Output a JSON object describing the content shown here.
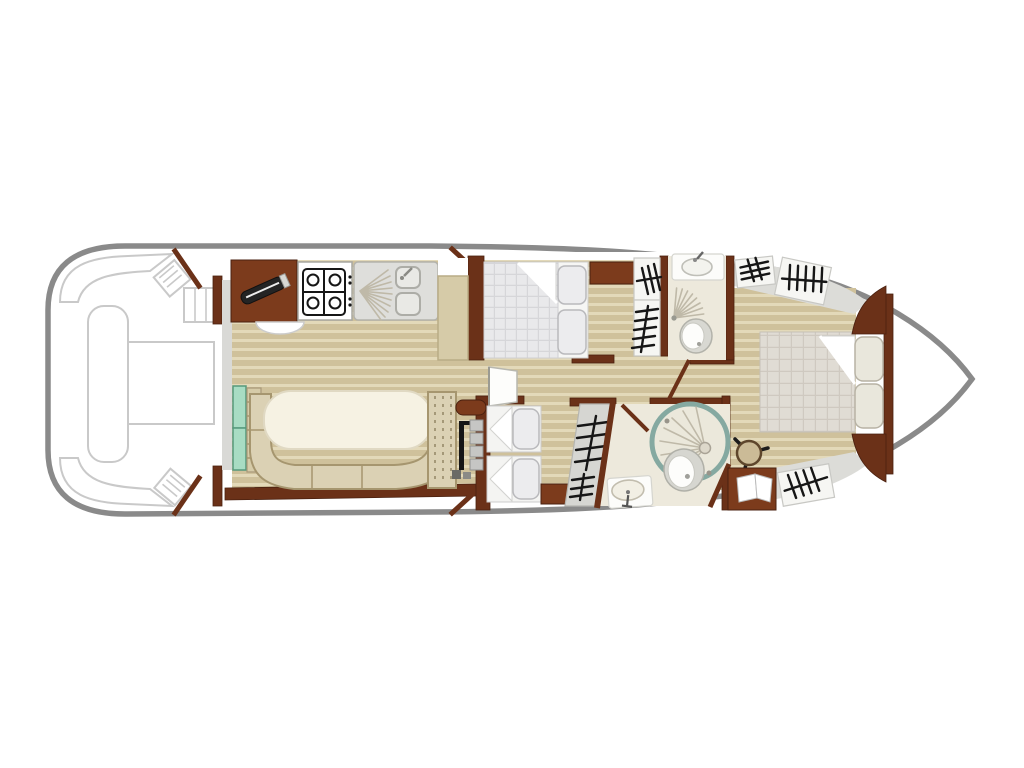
{
  "meta": {
    "title": "Canal boat deck plan (top view)",
    "type": "floor-plan",
    "orientation": "bow at right (pointed), aft deck at left (rounded)",
    "visible_text": []
  },
  "colors": {
    "hull": "#8a8a8a",
    "ext": "#c9c9c9",
    "wall": "#6b3118",
    "wall_dark": "#4a2110",
    "cabinet": "#7c3b1c",
    "floor": "#cfc19b",
    "floor_light": "#e3d9b9",
    "bench": "#dbd1b4",
    "bench_border": "#a6966f",
    "table": "#f6f2e3",
    "mint": "#a8dcc3",
    "mint_border": "#56997c",
    "duvet": "#e9e9eb",
    "duvet_grid": "#d6d6d9",
    "aft_duvet": "#e0dcd4",
    "aft_grid": "#cfc9c0",
    "bath": "#ede9dc",
    "teal": "#85a9a1",
    "fixture": "#d8d8d2",
    "fixture_border": "#b1b1a9",
    "symbol": "#161616",
    "shade": "#dcdcd8"
  },
  "areas": [
    {
      "name": "aft-deck",
      "items": [
        "corner-bench-port",
        "corner-bench-starboard",
        "side-bench",
        "deck-table",
        "stool-port",
        "stool-starboard",
        "boarding-steps",
        "companionway-doors"
      ]
    },
    {
      "name": "galley",
      "items": [
        "worktop-cabinet",
        "cutting-board",
        "stove-4-burner",
        "double-sink-with-drainer",
        "end-counter",
        "basin"
      ]
    },
    {
      "name": "saloon",
      "items": [
        "u-shaped-bench",
        "oval-table",
        "mint-entry-steps",
        "step-ladder",
        "helm-bench",
        "helm-console",
        "steering-wheel-inside",
        "helm-seat-pads"
      ]
    },
    {
      "name": "mid-cabin",
      "items": [
        "double-bed",
        "checkered-duvet",
        "sheet-fold",
        "pillow",
        "pillow",
        "nightstand",
        "wardrobe-comb",
        "wardrobe-rack"
      ]
    },
    {
      "name": "mid-bathroom",
      "items": [
        "washbasin",
        "shower-spray",
        "toilet"
      ]
    },
    {
      "name": "corridor",
      "items": [
        "open-door-leaf-white",
        "door-leaf-bathroom"
      ]
    },
    {
      "name": "lower-cabin",
      "items": [
        "single-bed",
        "single-bed",
        "pillow",
        "pillow",
        "cabinet",
        "slanted-wardrobe-rack"
      ]
    },
    {
      "name": "lower-bathroom",
      "items": [
        "round-shower",
        "toilet",
        "washbasin",
        "door-leaf"
      ]
    },
    {
      "name": "aft-cabin",
      "items": [
        "double-bed",
        "checkered-duvet",
        "sheet-fold",
        "pillow",
        "pillow",
        "wardrobe-comb",
        "wardrobe-hatch",
        "wardrobe-hatch",
        "steering-wheel",
        "chart-locker-open-book",
        "headboard-corner",
        "headboard-corner"
      ]
    },
    {
      "name": "bow",
      "items": [
        "pointed-bow-deck"
      ]
    }
  ]
}
